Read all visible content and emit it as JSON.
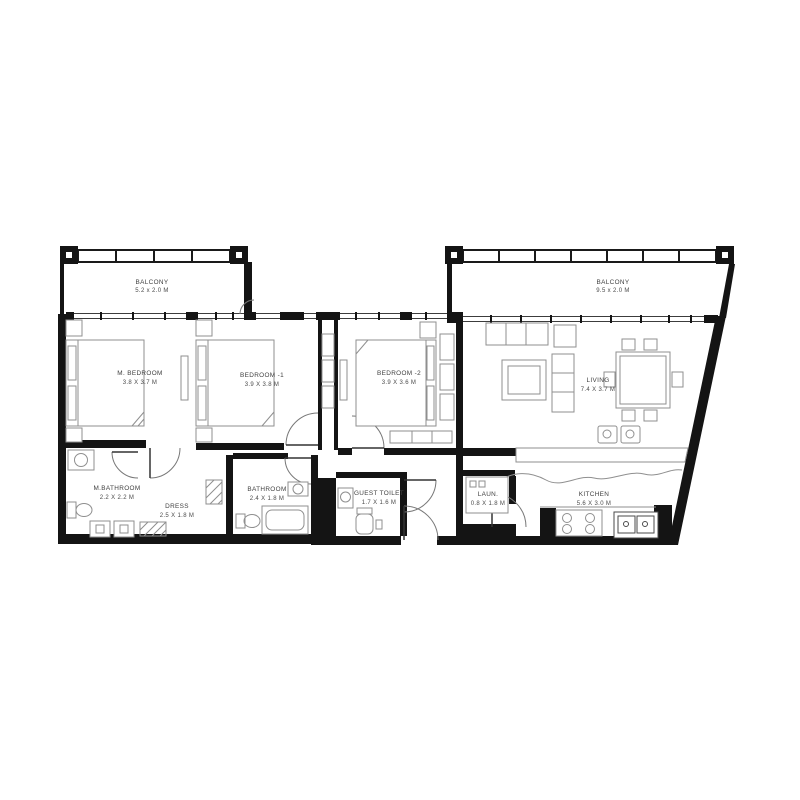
{
  "drawing": {
    "type": "apartment-floor-plan",
    "background": "#ffffff",
    "wall_color": "#141414",
    "line_color": "#3c3c3c",
    "furniture_color": "#8f8f8f",
    "text_color": "#3f3f3f"
  },
  "rooms": {
    "balcony_left": {
      "name": "BALCONY",
      "dims": "5.2 x 2.0 M"
    },
    "balcony_right": {
      "name": "BALCONY",
      "dims": "9.5 x 2.0 M"
    },
    "master_bedroom": {
      "name": "M. BEDROOM",
      "dims": "3.8 X 3.7 M"
    },
    "bedroom_1": {
      "name": "BEDROOM -1",
      "dims": "3.9 X 3.8 M"
    },
    "bedroom_2": {
      "name": "BEDROOM -2",
      "dims": "3.9 X 3.6 M"
    },
    "living": {
      "name": "LIVING",
      "dims": "7.4 X 3.7 M"
    },
    "master_bathroom": {
      "name": "M.BATHROOM",
      "dims": "2.2 X 2.2 M"
    },
    "dress": {
      "name": "DRESS",
      "dims": "2.5 X 1.8 M"
    },
    "bathroom": {
      "name": "BATHROOM",
      "dims": "2.4 X 1.8 M"
    },
    "guest_toilet": {
      "name": "GUEST TOILET",
      "dims": "1.7 X 1.6 M"
    },
    "laundry": {
      "name": "LAUN.",
      "dims": "0.8 X 1.8 M"
    },
    "kitchen": {
      "name": "KITCHEN",
      "dims": "5.6 X 3.0 M"
    }
  }
}
